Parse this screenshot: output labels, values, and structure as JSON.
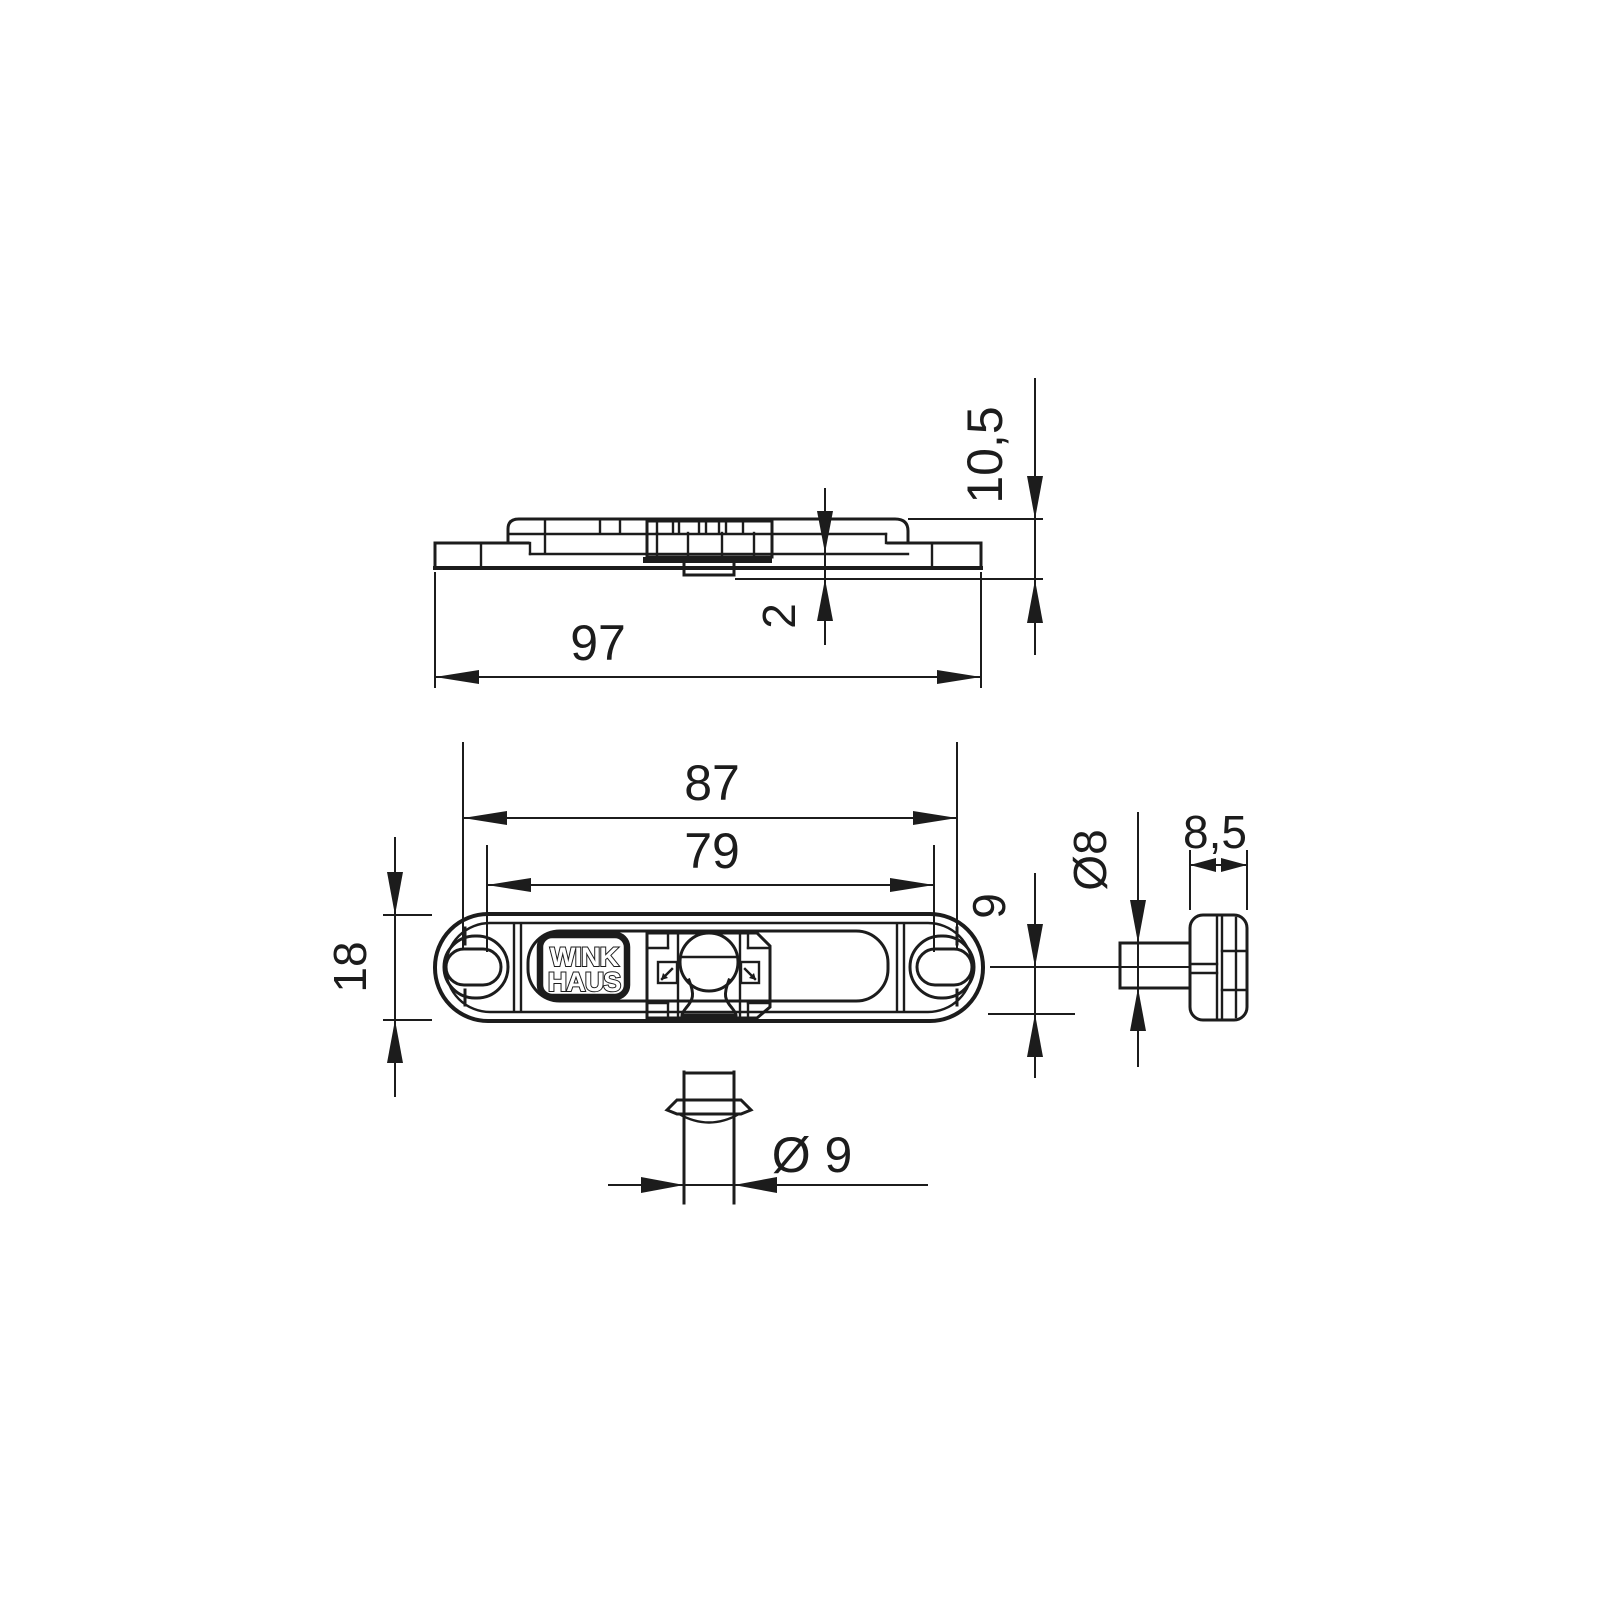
{
  "page": {
    "background": "#ffffff",
    "line_color": "#1c1c1c",
    "description": "Technical dimensional drawing of a Winkhaus striker / mushroom cam plate, three orthographic views plus pin detail"
  },
  "brand": {
    "line1": "WINK",
    "line2": "HAUS"
  },
  "dimensions": {
    "overall_length": "97",
    "overall_height": "10,5",
    "protrusion": "2",
    "hole_spacing": "87",
    "adjustment_span": "79",
    "plate_width": "18",
    "center_to_edge": "9",
    "pin_diameter": "Ø 9",
    "cam_shaft_diameter": "Ø8",
    "cam_head_width": "8,5"
  }
}
